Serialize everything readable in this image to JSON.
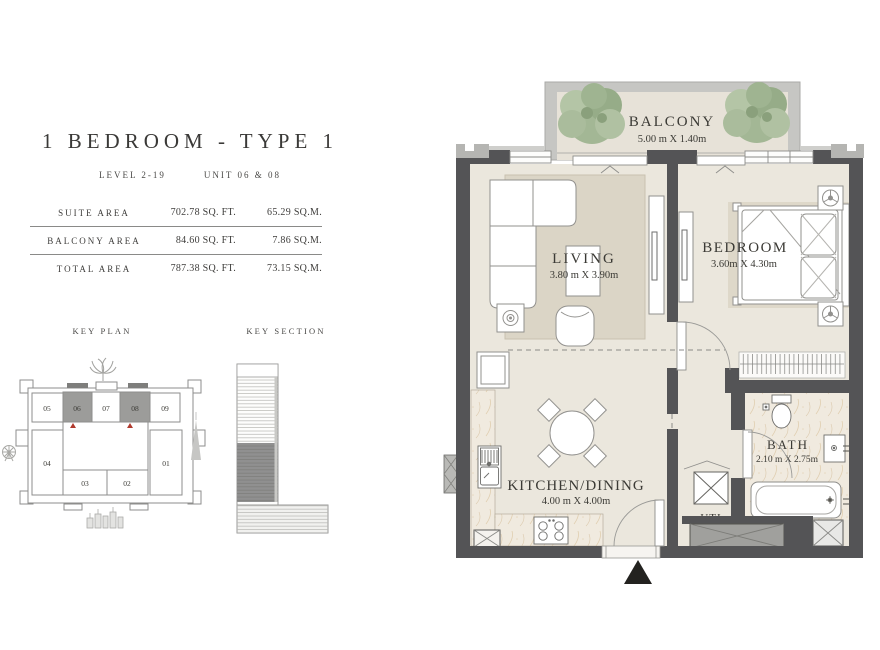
{
  "header": {
    "title": "1 BEDROOM - TYPE 1",
    "level": "LEVEL 2-19",
    "unit": "UNIT 06 & 08"
  },
  "area_table": {
    "rows": [
      {
        "label": "SUITE AREA",
        "sqft": "702.78 SQ. FT.",
        "sqm": "65.29 SQ.M."
      },
      {
        "label": "BALCONY AREA",
        "sqft": "84.60 SQ. FT.",
        "sqm": "7.86 SQ.M."
      },
      {
        "label": "TOTAL AREA",
        "sqft": "787.38 SQ. FT.",
        "sqm": "73.15 SQ.M."
      }
    ]
  },
  "key_plan": {
    "label": "KEY PLAN",
    "units": [
      "05",
      "06",
      "07",
      "08",
      "09",
      "04",
      "01",
      "03",
      "02"
    ],
    "highlighted_units": [
      "06",
      "08"
    ]
  },
  "key_section": {
    "label": "KEY SECTION"
  },
  "rooms": {
    "balcony": {
      "name": "BALCONY",
      "dims": "5.00 m X 1.40m"
    },
    "living": {
      "name": "LIVING",
      "dims": "3.80 m X 3.90m"
    },
    "bedroom": {
      "name": "BEDROOM",
      "dims": "3.60m X 4.30m"
    },
    "kitchen": {
      "name": "KITCHEN/DINING",
      "dims": "4.00 m X 4.00m"
    },
    "bath": {
      "name": "BATH",
      "dims": "2.10 m X 2.75m"
    },
    "utility": {
      "name": "UTI"
    }
  },
  "colors": {
    "wall": "#545456",
    "floor": "#ebe7dd",
    "rug": "#dbd5c6",
    "balcony_wall": "#c6c6c3",
    "plant_green": "#a3b795",
    "unit_highlight": "#9c9c9a",
    "marker_red": "#b03a2e"
  }
}
